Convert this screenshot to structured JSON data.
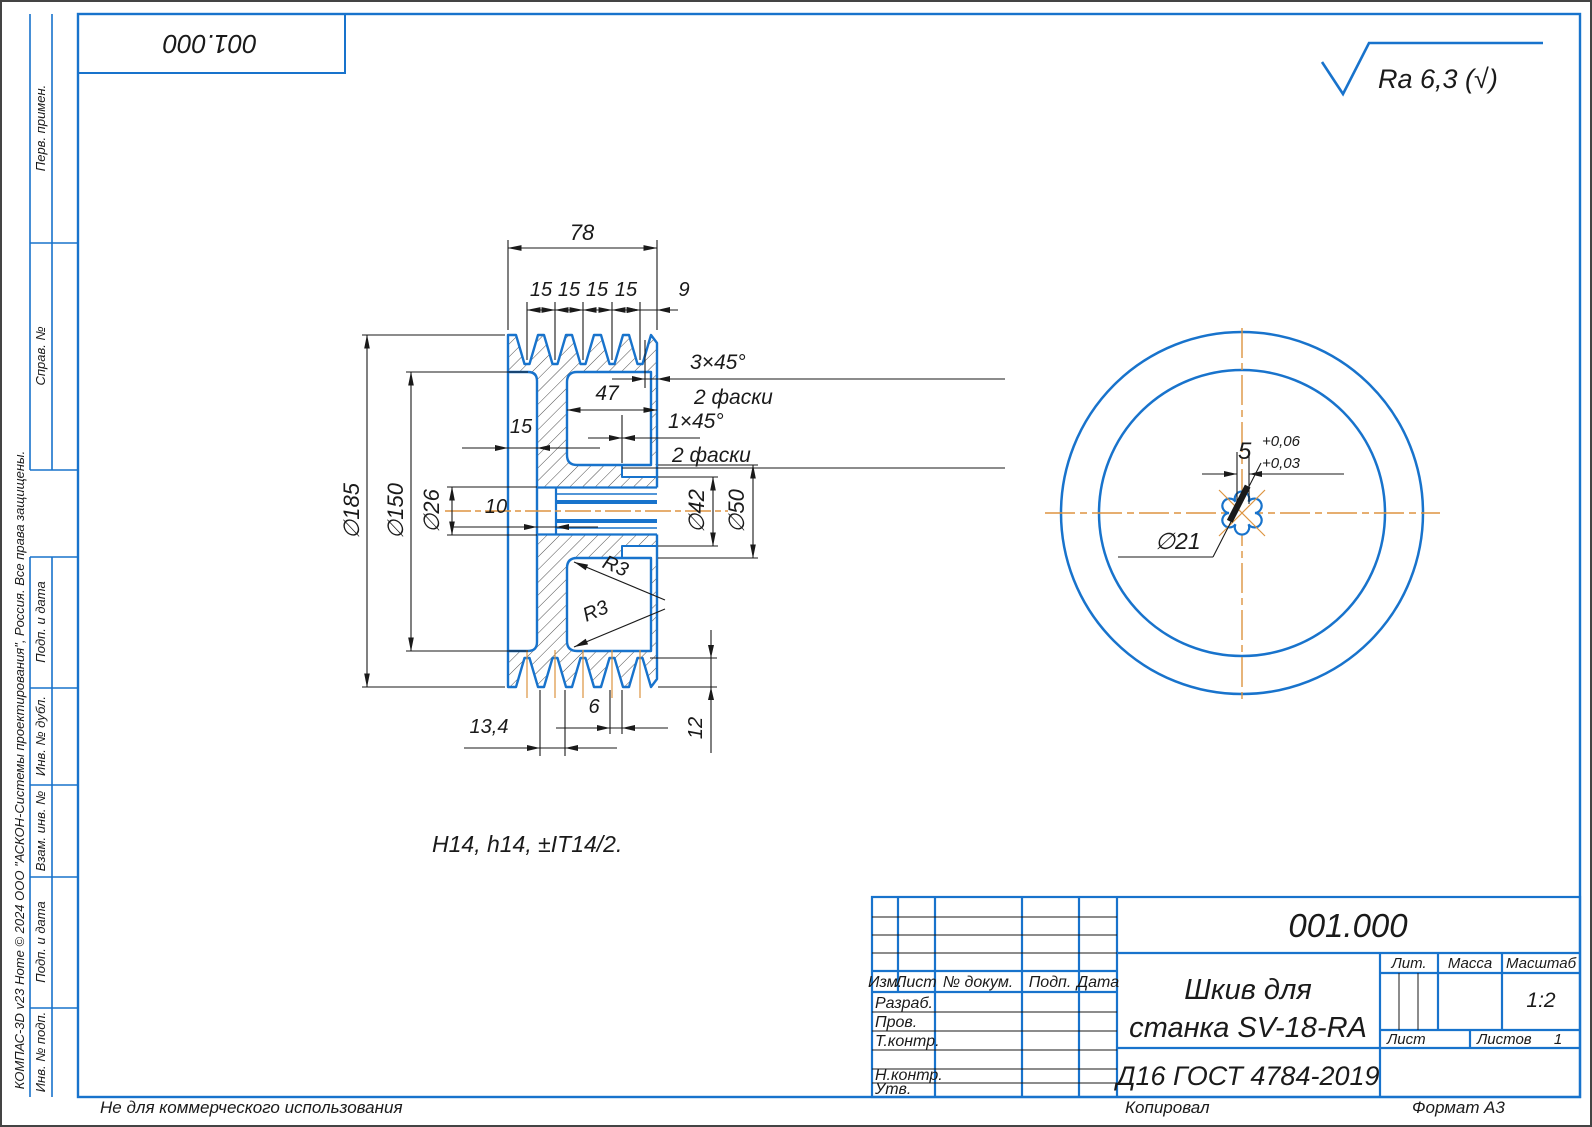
{
  "sheet": {
    "designation_top": "001.000",
    "roughness": "Ra 6,3 (√)",
    "tolerance_note": "H14, h14, ±IT14/2.",
    "copyright": "КОМПАС-3D v23 Home © 2024 ООО \"АСКОН-Системы проектирования\", Россия. Все права защищены.",
    "footer": {
      "not_commercial": "Не для коммерческого использования",
      "copied": "Копировал",
      "format_label": "Формат",
      "format_value": "А3"
    }
  },
  "margin_labels": [
    "Перв. примен.",
    "Справ. №",
    "Подп. и дата",
    "Инв. № дубл.",
    "Взам. инв. №",
    "Подп. и дата",
    "Инв. № подп."
  ],
  "section": {
    "dims": {
      "total": "78",
      "pitches": [
        "15",
        "15",
        "15",
        "15"
      ],
      "end": "9",
      "chamfer_outer": "3×45°",
      "chamfer_outer_note": "2 фаски",
      "recess_width": "47",
      "chamfer_inner": "1×45°",
      "chamfer_inner_note": "2 фаски",
      "recess_depth": "15",
      "counterbore_depth": "10",
      "d185": "∅185",
      "d150": "∅150",
      "d26": "∅26",
      "d42": "∅42",
      "d50": "∅50",
      "r3a": "R3",
      "r3b": "R3",
      "groove_offset": "13,4",
      "groove_top": "6",
      "groove_depth": "12"
    }
  },
  "front": {
    "dims": {
      "keyway": "5",
      "tol_up": "+0,06",
      "tol_low": "+0,03",
      "bore": "∅21"
    }
  },
  "title_block": {
    "designation": "001.000",
    "title_line1": "Шкив для",
    "title_line2": "станка SV-18-RA",
    "material": "Д16 ГОСТ 4784-2019",
    "headers": {
      "izm": "Изм.",
      "list": "Лист",
      "doc": "№ докум.",
      "podp": "Подп.",
      "data": "Дата"
    },
    "rows": {
      "razrab": "Разраб.",
      "prov": "Пров.",
      "tkontr": "Т.контр.",
      "nkontr": "Н.контр.",
      "utv": "Утв."
    },
    "right": {
      "lit": "Лит.",
      "massa": "Масса",
      "masshtab": "Масштаб",
      "scale": "1:2",
      "list": "Лист",
      "listov": "Листов",
      "listov_value": "1"
    }
  }
}
